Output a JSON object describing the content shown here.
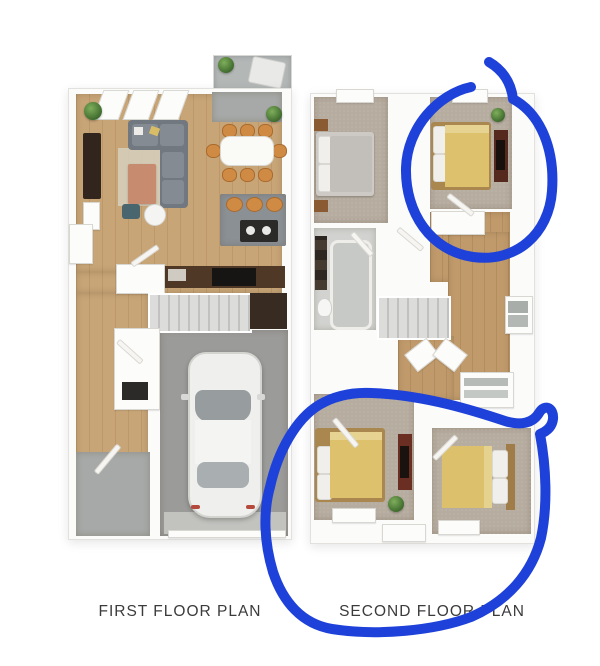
{
  "image": {
    "background": "#ffffff"
  },
  "floor_plans": {
    "first": {
      "label": "FIRST FLOOR PLAN"
    },
    "second": {
      "label": "SECOND FLOOR PLAN"
    }
  },
  "annotations": {
    "pen_color": "#1e41d9",
    "items": [
      {
        "name": "upper-bedroom-circle",
        "shape": "hand-drawn-loop"
      },
      {
        "name": "lower-bedrooms-circle",
        "shape": "hand-drawn-loop"
      }
    ]
  }
}
